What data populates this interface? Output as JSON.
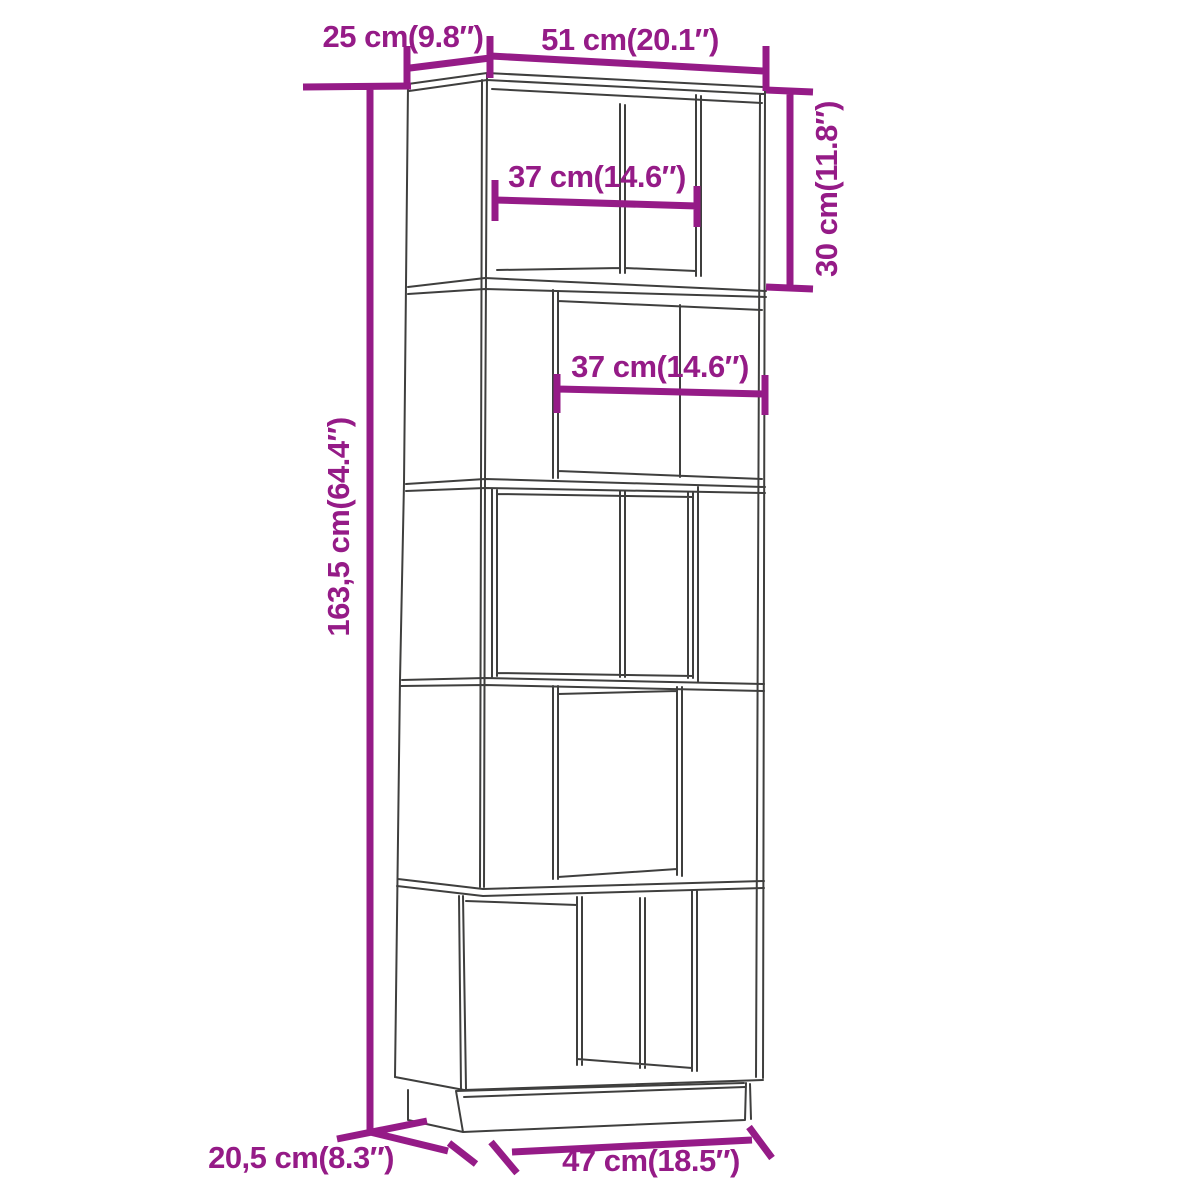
{
  "diagram": {
    "type": "furniture-dimension-diagram",
    "product": "5-tier book cabinet room divider line drawing",
    "colors": {
      "dimension": "#951b87",
      "outline": "#3f3f3e",
      "background": "#ffffff"
    },
    "labels": {
      "top_depth": "25 cm(9.8″)",
      "top_width": "51 cm(20.1″)",
      "top_inner_width": "37 cm(14.6″)",
      "top_section_height": "30 cm(11.8″)",
      "middle_inner_width": "37 cm(14.6″)",
      "total_height": "163,5 cm(64.4″)",
      "base_depth": "20,5 cm(8.3″)",
      "base_width": "47 cm(18.5″)"
    }
  }
}
